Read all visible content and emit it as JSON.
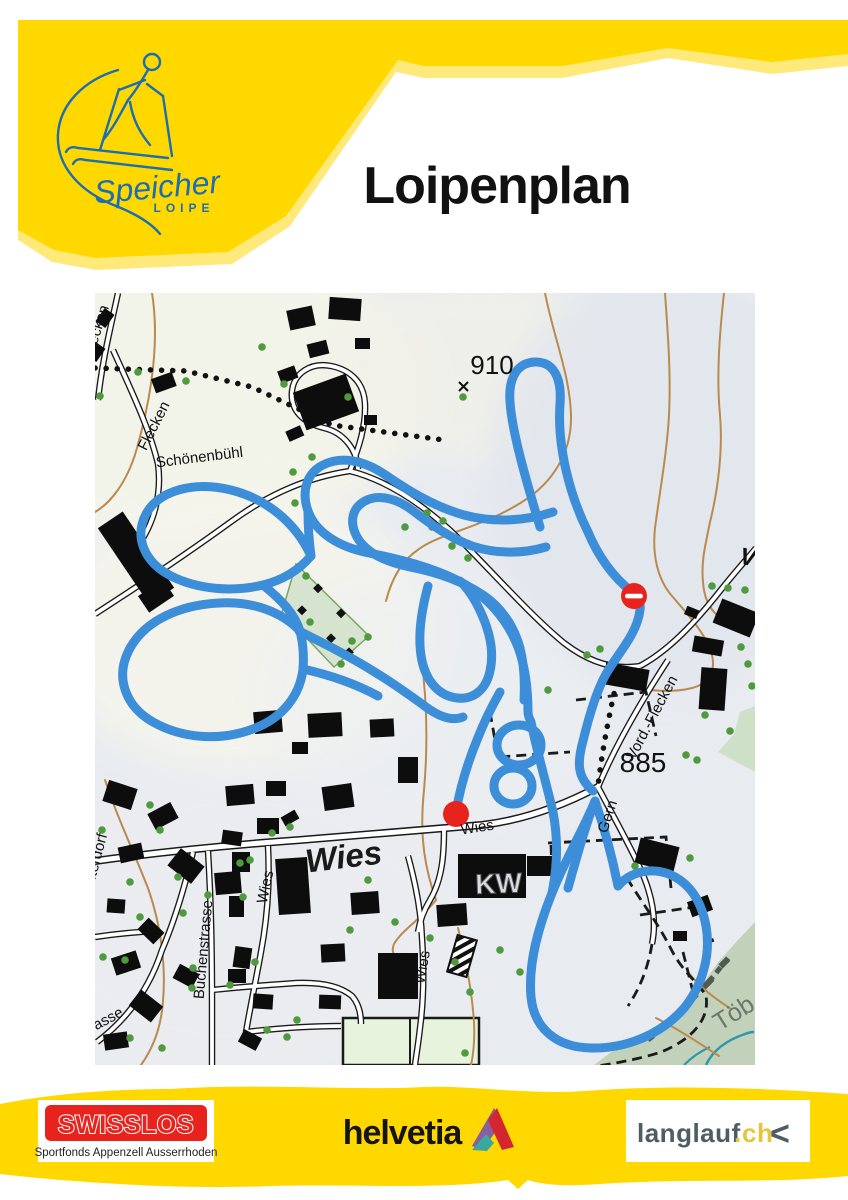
{
  "header": {
    "title": "Loipenplan",
    "logo": {
      "script": "Speicher",
      "sub": "LOIPE"
    }
  },
  "map": {
    "labels": {
      "flecken_upper": "Flecken",
      "flecken_lower": "Flecken",
      "schoenenbuehl": "Schönenbühl",
      "peak_910": "910",
      "summit_mark": "×",
      "vord_flecken": "-Vord.-Flecken",
      "elevation_885": "885",
      "gern": "Gern",
      "wies_street": "Wies",
      "wies_place": "Wies",
      "kw_station": "KW",
      "interdorf": "Interdorf",
      "buchenstrasse": "Buchenstrasse",
      "wies_lane_a": "Wies",
      "wies_lane_b": "Wies",
      "strasse_partial": "rasse",
      "toebeli": "Töb",
      "v_partial": "V"
    },
    "colors": {
      "trail": "#3d8ed9",
      "marker": "#e8231d",
      "contour": "#b98a4e",
      "tree": "#4e9a3d",
      "brand_yellow": "#ffd800"
    }
  },
  "footer": {
    "swisslos": {
      "name": "SWISSLOS",
      "tagline": "Sportfonds Appenzell Ausserrhoden"
    },
    "helvetia": {
      "name": "helvetia"
    },
    "langlauf": {
      "name": "langlauf",
      "dot": ".",
      "tld": "ch",
      "chevron": "<"
    }
  }
}
